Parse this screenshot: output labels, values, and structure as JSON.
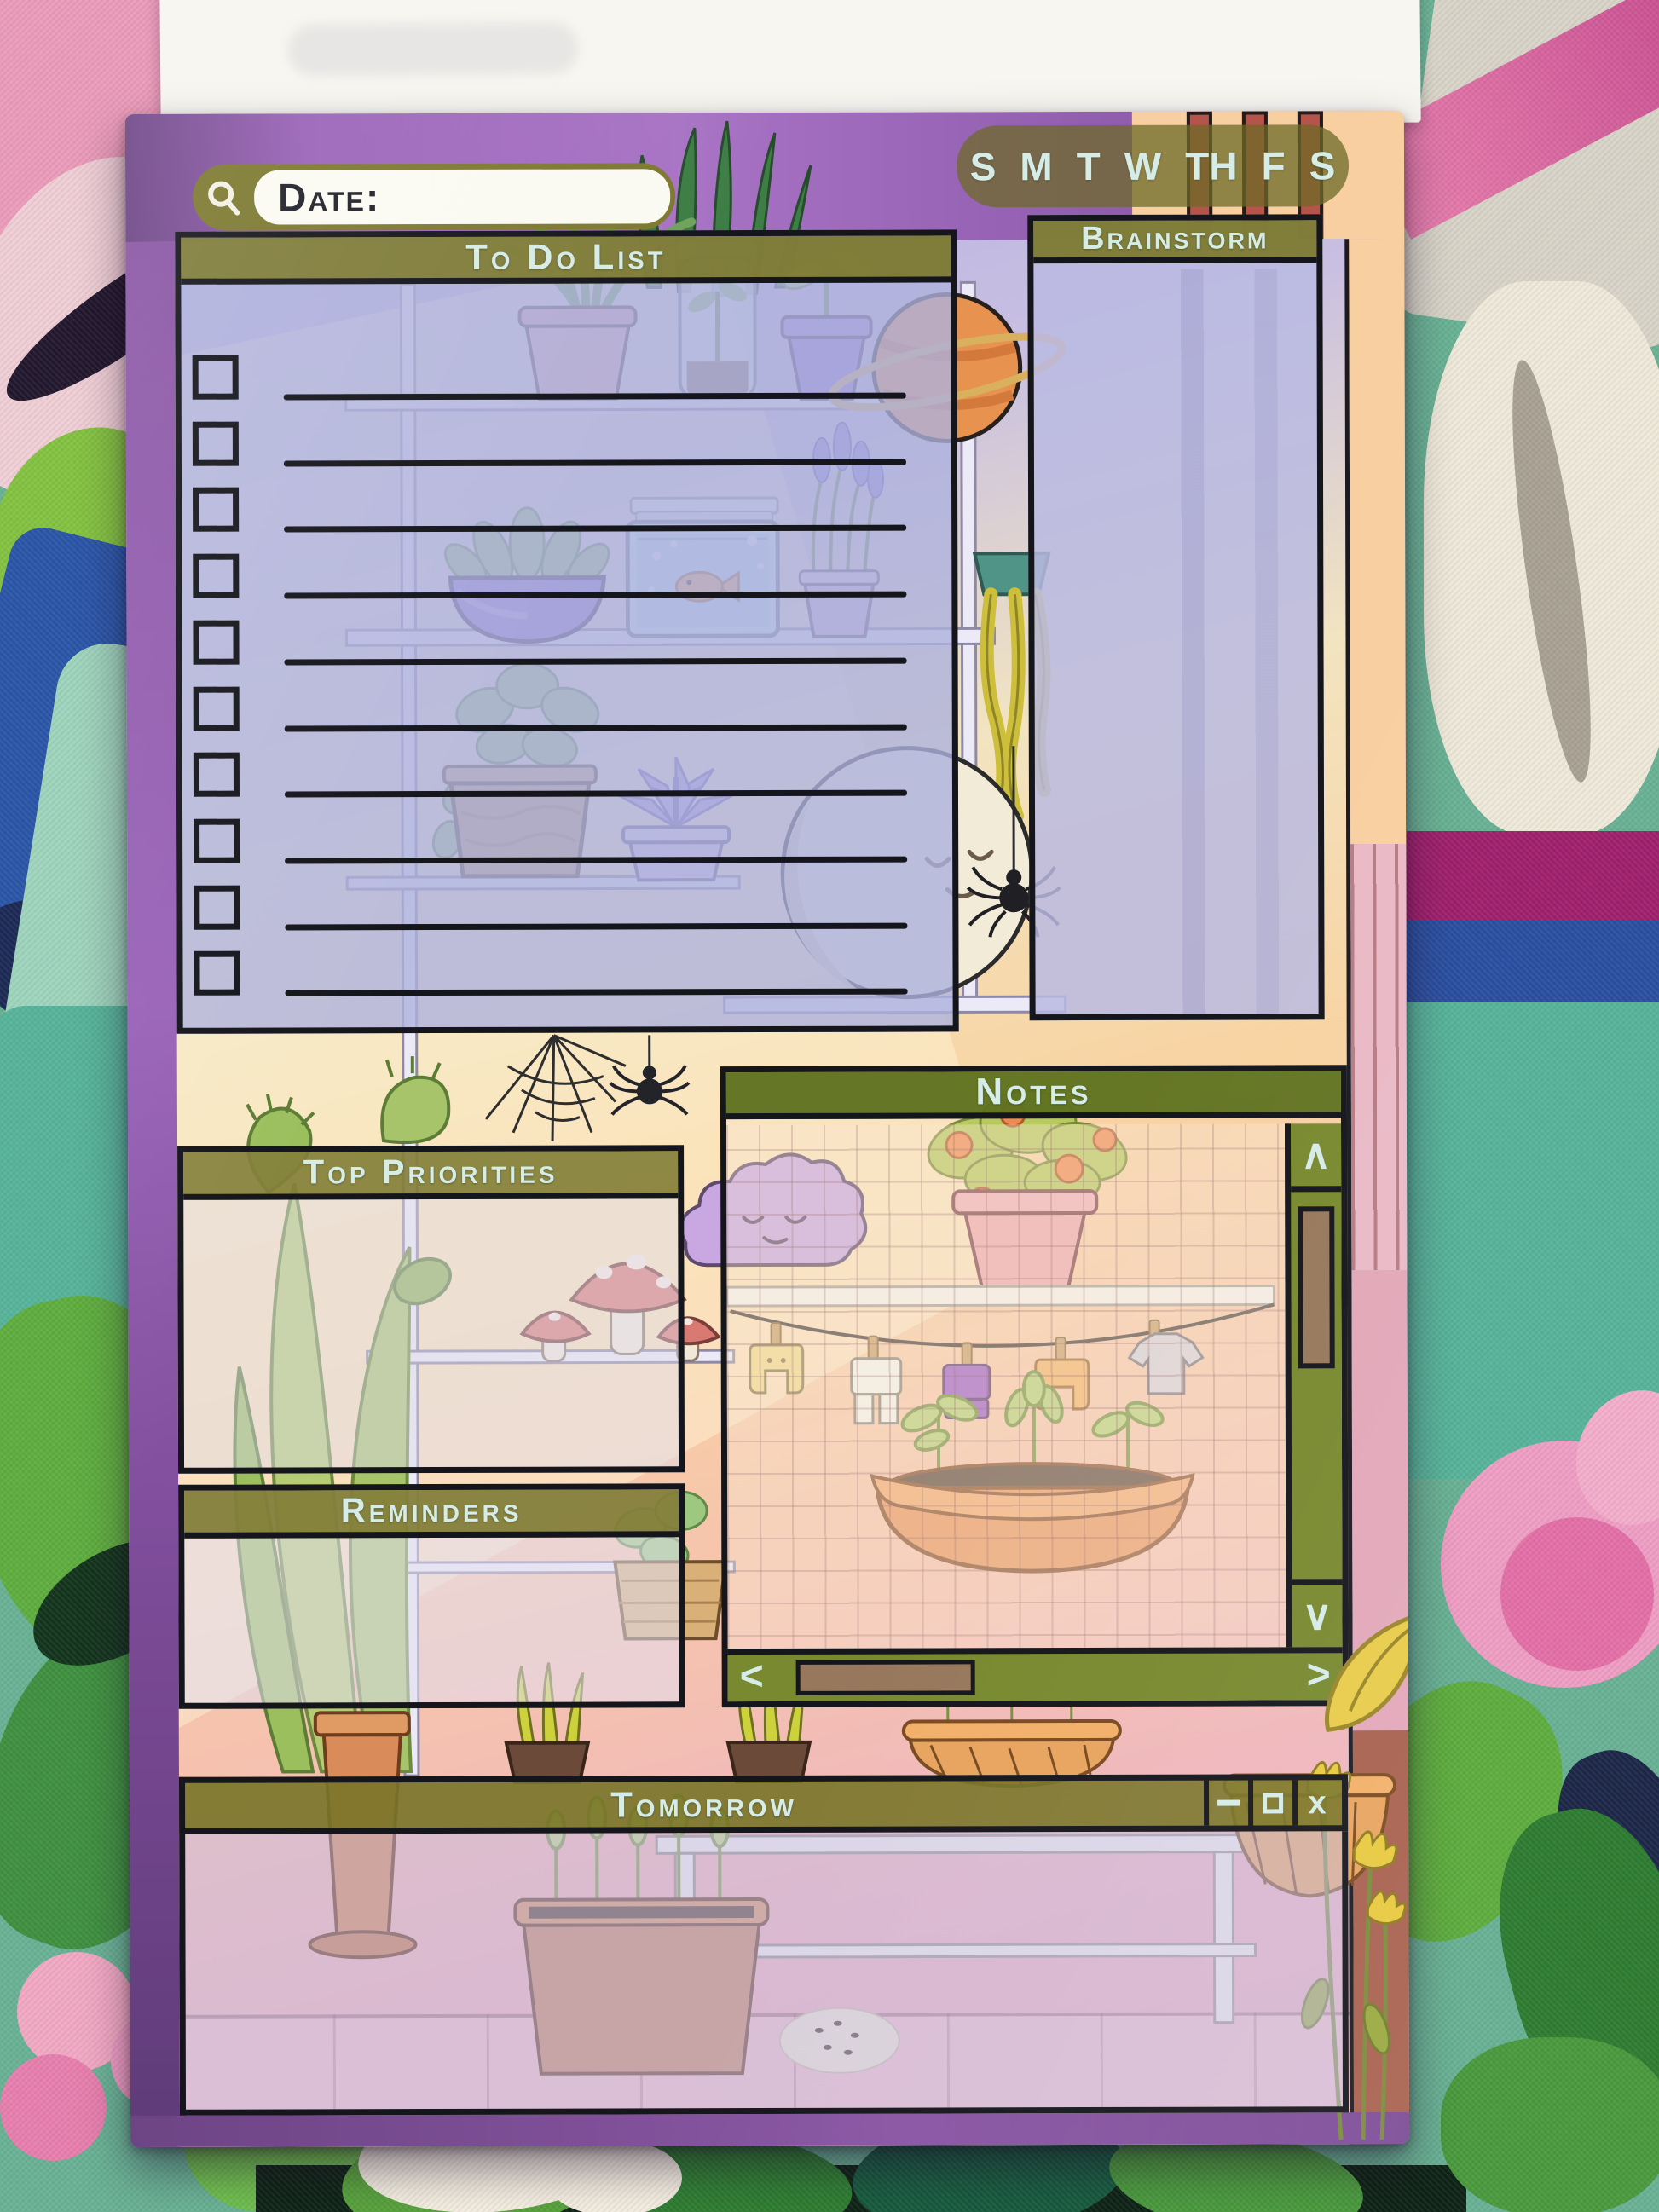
{
  "window": {
    "date_label": "Date:",
    "days": [
      "S",
      "M",
      "T",
      "W",
      "TH",
      "F",
      "S"
    ]
  },
  "panels": {
    "todo": {
      "title": "To Do List",
      "rows": 10
    },
    "brainstorm": {
      "title": "Brainstorm"
    },
    "notes": {
      "title": "Notes"
    },
    "top_priorities": {
      "title": "Top Priorities"
    },
    "reminders": {
      "title": "Reminders"
    },
    "tomorrow": {
      "title": "Tomorrow"
    }
  },
  "controls": {
    "close": "x",
    "scroll_up": "∧",
    "scroll_down": "∨",
    "scroll_left": "<",
    "scroll_right": ">"
  },
  "colors": {
    "ink": "#15151c",
    "olive": "#7d7930",
    "scroll_green": "#78892f",
    "thumb_brown": "#97785c",
    "text_light": "#d6ece7",
    "white_pill": "#fbfaf2"
  }
}
